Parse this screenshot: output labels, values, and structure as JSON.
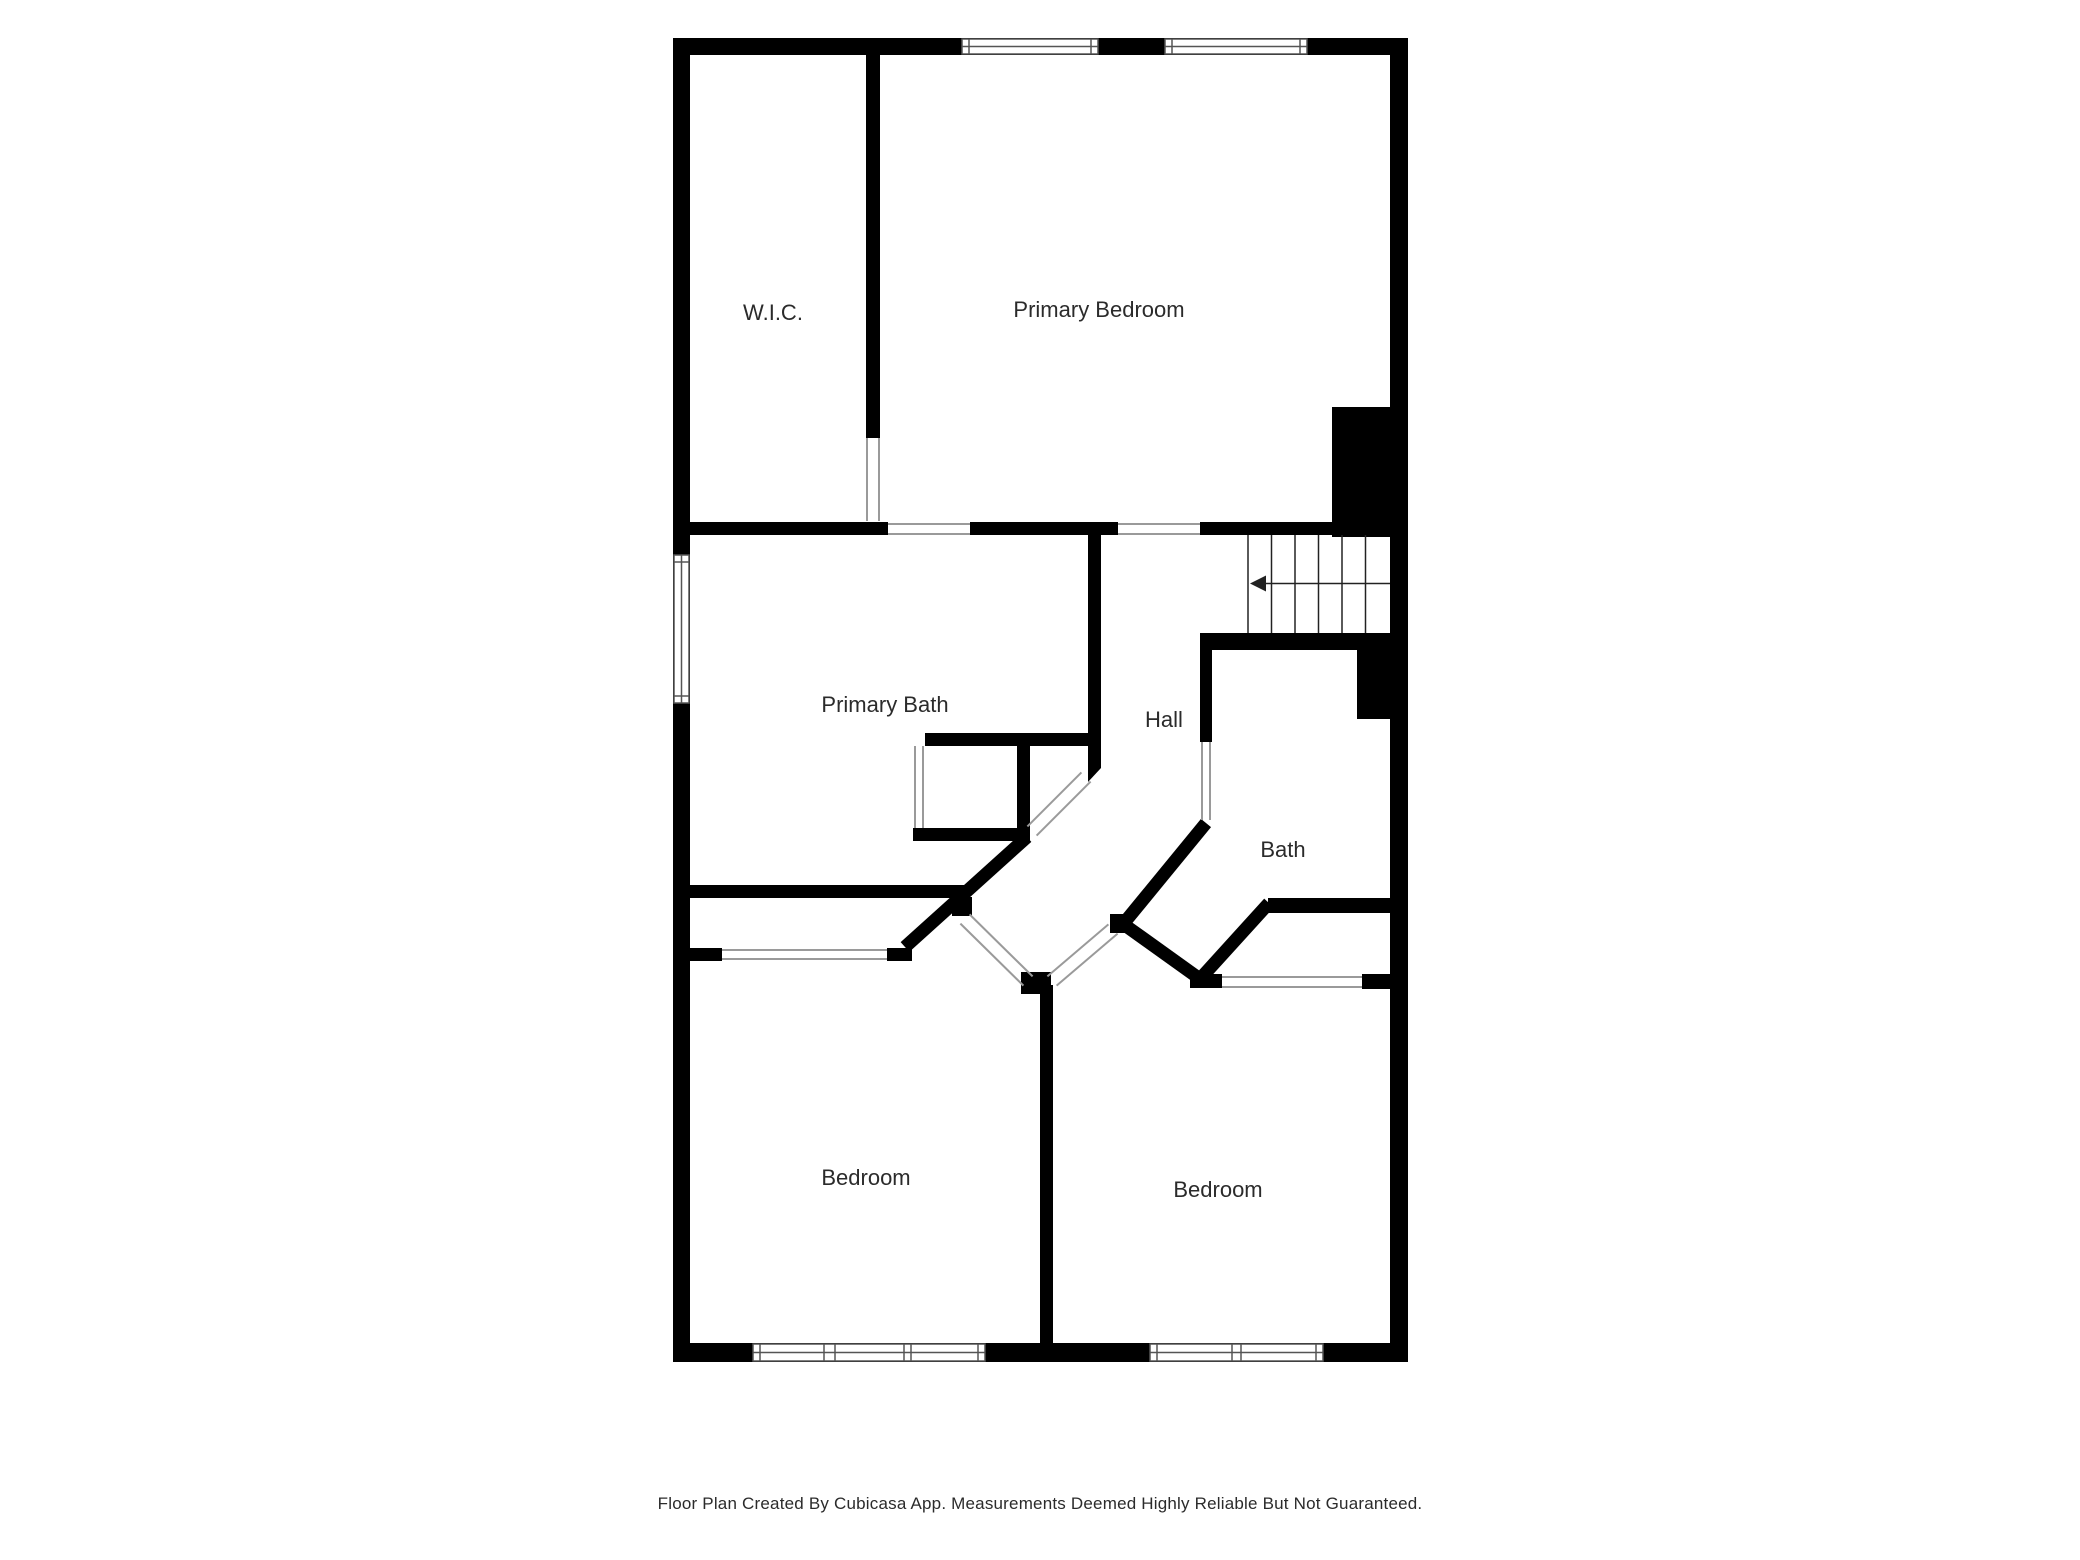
{
  "title": "Floor Plan",
  "colors": {
    "wall": "#000000",
    "opening_line": "#9a9a9a",
    "window_frame": "#555555",
    "stair_line": "#222222",
    "label": "#2b2b2b"
  },
  "rooms": {
    "wic": {
      "label": "W.I.C."
    },
    "primary_bedroom": {
      "label": "Primary Bedroom"
    },
    "primary_bath": {
      "label": "Primary Bath"
    },
    "hall": {
      "label": "Hall"
    },
    "bath": {
      "label": "Bath"
    },
    "bedroom_left": {
      "label": "Bedroom"
    },
    "bedroom_right": {
      "label": "Bedroom"
    }
  },
  "stairs": {
    "treads": 6,
    "direction_icon": "arrow-left"
  },
  "windows": {
    "top": 2,
    "left": 1,
    "bottom": 2
  },
  "footer": {
    "text": "Floor Plan Created By Cubicasa App. Measurements Deemed Highly Reliable But Not Guaranteed."
  }
}
